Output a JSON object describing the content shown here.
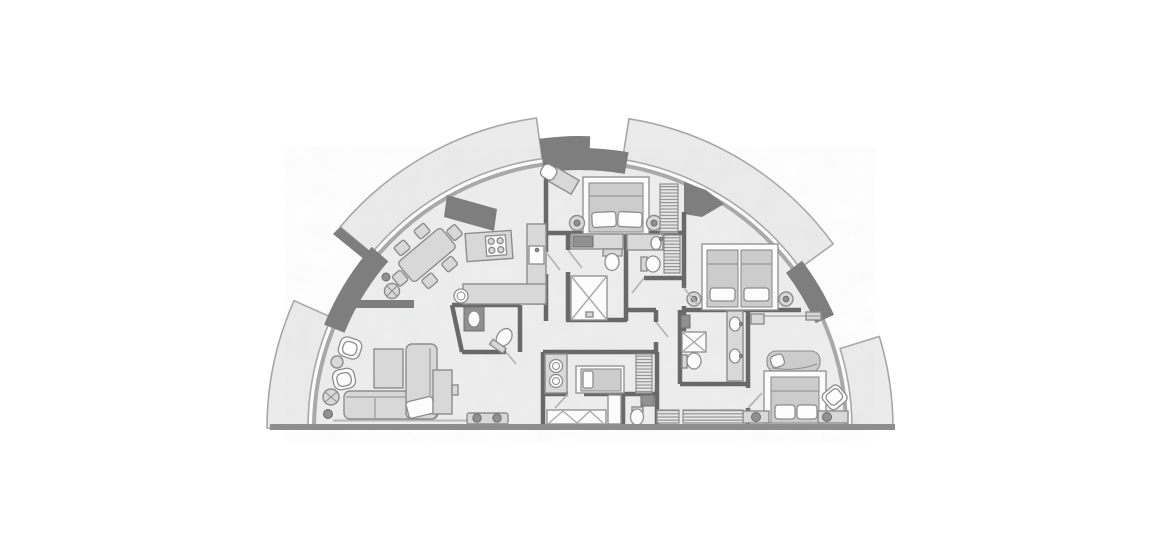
{
  "canvas": {
    "width": 1170,
    "height": 550,
    "background": "#ffffff"
  },
  "colors": {
    "background": "#ffffff",
    "floor": "#edeeed",
    "balcony": "#ebebeb",
    "balcony_stroke": "#a6a6a6",
    "wall": "#696969",
    "wall_heavy": "#7e7e7e",
    "exterior_wall": "#8e8e8e",
    "glazing": "#a9a9a9",
    "furniture": "#d8d8d8",
    "furniture_stroke": "#8d8d8d",
    "fixture_white": "#fcfcfc",
    "mattress": "#cccccc",
    "accent_dark": "#909090",
    "door": "#b5b5b5"
  },
  "plan": {
    "type": "residential-floor-plan",
    "shape": "semicircular-fan",
    "balconies": [
      "balcony-left",
      "balcony-top-left",
      "balcony-top-right",
      "balcony-right"
    ],
    "rooms": [
      {
        "name": "living-room",
        "furniture": [
          "l-shaped-sofa",
          "coffee-table",
          "armchair",
          "armchair",
          "side-table",
          "decor-table",
          "tv-console",
          "bench"
        ]
      },
      {
        "name": "dining-area",
        "furniture": [
          "dining-table-6-chairs",
          "console-table",
          "decor-circles"
        ]
      },
      {
        "name": "kitchen",
        "furniture": [
          "island-with-cooktop",
          "l-shaped-counter",
          "sink",
          "round-sink"
        ]
      },
      {
        "name": "powder-room",
        "furniture": [
          "washbasin",
          "toilet"
        ]
      },
      {
        "name": "bedroom-2",
        "furniture": [
          "double-bed",
          "nightstand",
          "nightstand",
          "wardrobe",
          "desk",
          "chair"
        ]
      },
      {
        "name": "ensuite-bathroom",
        "furniture": [
          "vanity-basin",
          "toilet",
          "shower"
        ]
      },
      {
        "name": "guest-bathroom",
        "furniture": [
          "vanity-basin",
          "toilet",
          "linen-cabinet"
        ]
      },
      {
        "name": "bedroom-3-twin",
        "furniture": [
          "single-bed",
          "single-bed",
          "nightstand",
          "nightstand",
          "wall-shelf"
        ]
      },
      {
        "name": "master-bathroom",
        "furniture": [
          "double-vanity",
          "shower",
          "toilet",
          "washbasin"
        ]
      },
      {
        "name": "master-bedroom",
        "furniture": [
          "king-bed",
          "chaise-longue",
          "armchair",
          "bedside-cabinet",
          "bedside-cabinet",
          "wardrobe-rail"
        ]
      },
      {
        "name": "maid-room",
        "furniture": [
          "single-bed",
          "kitchenette",
          "wardrobe"
        ]
      },
      {
        "name": "maid-bathroom",
        "furniture": [
          "washbasin",
          "toilet",
          "tall-cabinet"
        ]
      },
      {
        "name": "hallway",
        "furniture": [
          "built-in-closet",
          "linen-closet",
          "closet-run"
        ]
      }
    ]
  }
}
